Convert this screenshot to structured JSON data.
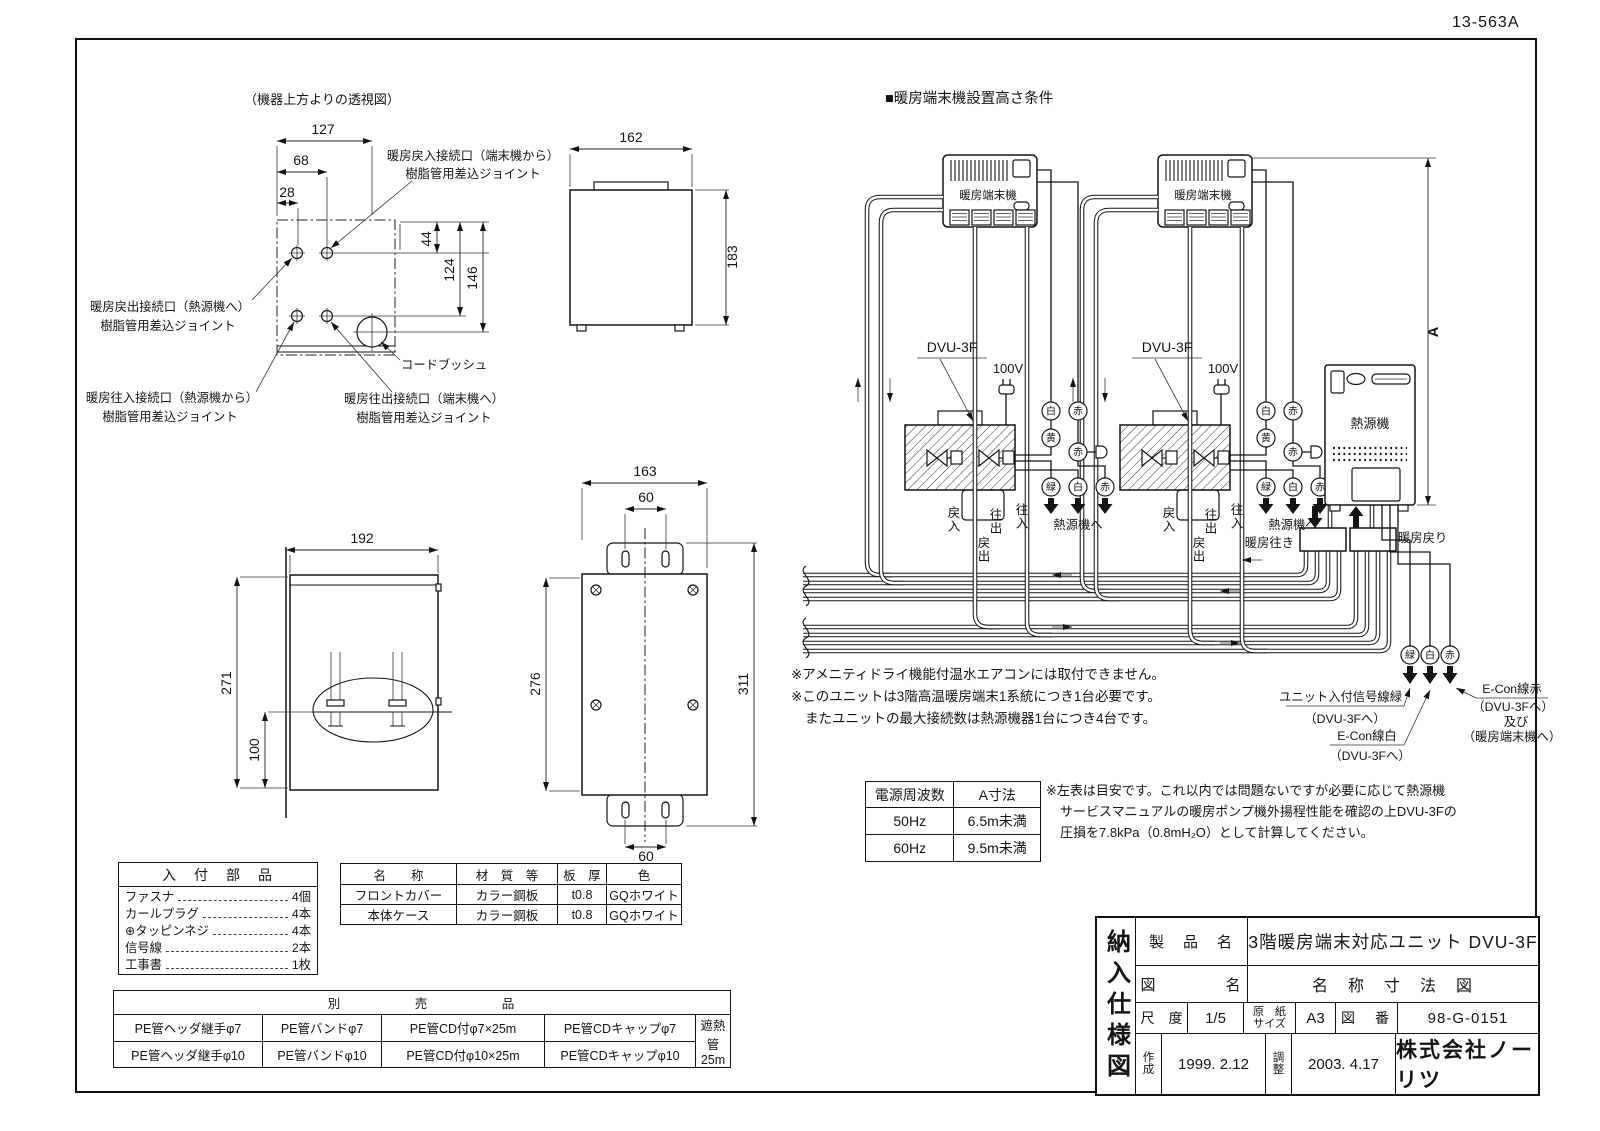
{
  "page": {
    "doc_code": "13-563A"
  },
  "top_view": {
    "title": "（機器上方よりの透視図）",
    "d127": "127",
    "d68": "68",
    "d28": "28",
    "d44": "44",
    "d124": "124",
    "d146": "146",
    "return_in_1": "暖房戻入接続口（端末機から）",
    "return_in_2": "樹脂管用差込ジョイント",
    "return_out_1": "暖房戻出接続口（熱源機へ）",
    "return_out_2": "樹脂管用差込ジョイント",
    "supply_in_1": "暖房往入接続口（熱源機から）",
    "supply_in_2": "樹脂管用差込ジョイント",
    "supply_out_1": "暖房往出接続口（端末機へ）",
    "supply_out_2": "樹脂管用差込ジョイント",
    "cord_bush": "コードブッシュ"
  },
  "side_view": {
    "w": "162",
    "h": "183"
  },
  "front_view": {
    "w": "192",
    "h": "271",
    "pipe_h": "100"
  },
  "back_view": {
    "w": "163",
    "pitch_top": "60",
    "body_h": "276",
    "total_h": "311",
    "pitch_bottom": "60"
  },
  "schematic": {
    "title": "■暖房端末機設置高さ条件",
    "terminal": "暖房端末機",
    "dvu": "DVU-3F",
    "power": "100V",
    "heat_source": "熱源機",
    "to_heat_source": "熱源機へ",
    "white": "白",
    "red": "赤",
    "yellow": "黄",
    "green": "緑",
    "return_in": "戻入",
    "supply_out": "往出",
    "return_out": "戻出",
    "supply_in": "往入",
    "supply_header": "暖房往き",
    "return_header": "暖房戻り",
    "dim_a": "A",
    "sig_green_1": "ユニット入付信号線緑",
    "sig_green_2": "（DVU-3Fへ）",
    "sig_white_1": "E-Con線白",
    "sig_white_2": "（DVU-3Fへ）",
    "sig_red_1": "E-Con線赤",
    "sig_red_2": "（DVU-3Fへ）",
    "sig_red_3": "及び",
    "sig_red_4": "（暖房端末機へ）"
  },
  "notes": {
    "l1": "※アメニティドライ機能付温水エアコンには取付できません。",
    "l2": "※このユニットは3階高温暖房端末1系統につき1台必要です。",
    "l3": "またユニットの最大接続数は熱源機器1台につき4台です。"
  },
  "freq_table": {
    "h1": "電源周波数",
    "h2": "A寸法",
    "r1c1": "50Hz",
    "r1c2": "6.5m未満",
    "r2c1": "60Hz",
    "r2c2": "9.5m未満"
  },
  "freq_note": {
    "l1": "※左表は目安です。これ以内では問題ないですが必要に応じて熱源機",
    "l2": "サービスマニュアルの暖房ポンプ機外揚程性能を確認の上DVU-3Fの",
    "l3": "圧損を7.8kPa（0.8mH₂O）として計算してください。"
  },
  "parts_table": {
    "title": "入　付　部　品",
    "items": [
      {
        "name": "ファスナ",
        "qty": "4個"
      },
      {
        "name": "カールプラグ",
        "qty": "4本"
      },
      {
        "name": "⊕タッピンネジ",
        "qty": "4本"
      },
      {
        "name": "信号線",
        "qty": "2本"
      },
      {
        "name": "工事書",
        "qty": "1枚"
      }
    ]
  },
  "material_table": {
    "h1": "名　　称",
    "h2": "材　質　等",
    "h3": "板　厚",
    "h4": "色",
    "r1c1": "フロントカバー",
    "r1c2": "カラー鋼板",
    "r1c3": "t0.8",
    "r1c4": "GQホワイト",
    "r2c1": "本体ケース",
    "r2c2": "カラー鋼板",
    "r2c3": "t0.8",
    "r2c4": "GQホワイト"
  },
  "optional_table": {
    "title": "別　　　　　売　　　　　品",
    "r1c1": "PE管ヘッダ継手φ7",
    "r1c2": "PE管バンドφ7",
    "r1c3": "PE管CD付φ7×25m",
    "r1c4": "PE管CDキャップφ7",
    "r2c1": "PE管ヘッダ継手φ10",
    "r2c2": "PE管バンドφ10",
    "r2c3": "PE管CD付φ10×25m",
    "r2c4": "PE管CDキャップφ10",
    "span": "遮熱管25m"
  },
  "title_block": {
    "side": "納入仕様図",
    "product_label": "製　品　名",
    "product": "3階暖房端末対応ユニット DVU-3F",
    "drawing_label": "図　　　　名",
    "drawing": "名　称　寸　法　図",
    "scale_label": "尺　度",
    "scale": "1/5",
    "paper_label_1": "原　紙",
    "paper_label_2": "サイズ",
    "paper": "A3",
    "fig_label": "図　番",
    "fig_no": "98-G-0151",
    "created_label": "作成",
    "created": "1999. 2.12",
    "revised_label": "調整",
    "revised": "2003. 4.17",
    "company": "株式会社ノーリツ"
  }
}
